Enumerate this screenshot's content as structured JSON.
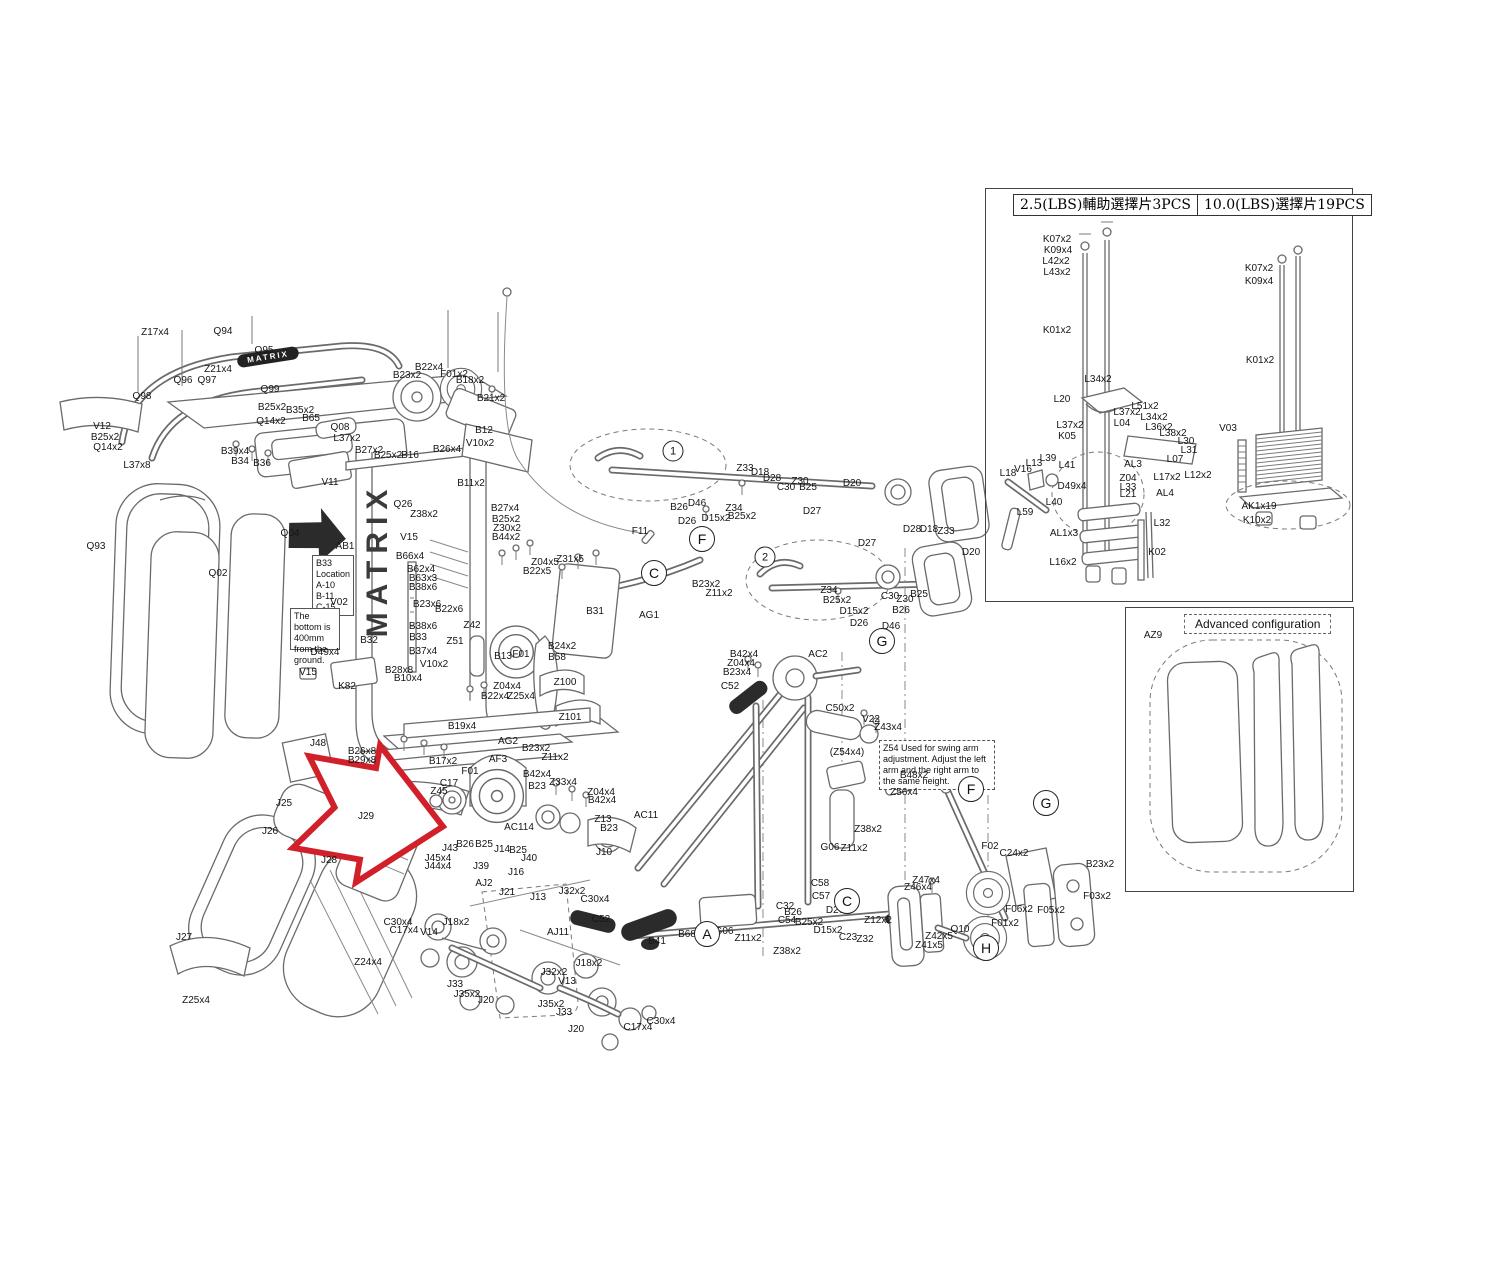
{
  "colors": {
    "background": "#ffffff",
    "line": "#6a6a6a",
    "label": "#151515",
    "arrow_red": "#d1202a",
    "arrow_black": "#111111"
  },
  "brand": "MATRIX",
  "inset_weight_stack": {
    "header_left": "2.5(LBS)輔助選擇片3PCS",
    "header_right": "10.0(LBS)選擇片19PCS"
  },
  "inset_advanced": {
    "title": "Advanced configuration",
    "label": "AZ9"
  },
  "notes": {
    "b33_line1": "B33",
    "b33_line2": "Location",
    "b33_line3": "A-10",
    "b33_line4": "B-11",
    "b33_line5": "C-15",
    "bottom_note": "The bottom is 400mm from the ground.",
    "z54_note": "Z54 Used for swing arm adjustment. Adjust the left arm and the right arm to the same height."
  },
  "callouts": [
    {
      "t": "1",
      "x": 673,
      "y": 451,
      "num": true
    },
    {
      "t": "2",
      "x": 765,
      "y": 557,
      "num": true
    },
    {
      "t": "C",
      "x": 654,
      "y": 573
    },
    {
      "t": "F",
      "x": 702,
      "y": 539
    },
    {
      "t": "G",
      "x": 882,
      "y": 641
    },
    {
      "t": "F",
      "x": 971,
      "y": 789
    },
    {
      "t": "G",
      "x": 1046,
      "y": 803
    },
    {
      "t": "A",
      "x": 707,
      "y": 934
    },
    {
      "t": "C",
      "x": 847,
      "y": 901
    },
    {
      "t": "H",
      "x": 986,
      "y": 948
    }
  ],
  "labels": [
    {
      "t": "Z17x4",
      "x": 155,
      "y": 333
    },
    {
      "t": "Q94",
      "x": 223,
      "y": 332
    },
    {
      "t": "Q95",
      "x": 264,
      "y": 351
    },
    {
      "t": "Z21x4",
      "x": 218,
      "y": 370
    },
    {
      "t": "Q96",
      "x": 183,
      "y": 381
    },
    {
      "t": "Q97",
      "x": 207,
      "y": 381
    },
    {
      "t": "Q98",
      "x": 142,
      "y": 397
    },
    {
      "t": "Q99",
      "x": 270,
      "y": 390
    },
    {
      "t": "B25x2",
      "x": 272,
      "y": 408
    },
    {
      "t": "Q14x2",
      "x": 271,
      "y": 422
    },
    {
      "t": "B35x2",
      "x": 300,
      "y": 411
    },
    {
      "t": "B65",
      "x": 311,
      "y": 419
    },
    {
      "t": "Q08",
      "x": 340,
      "y": 428
    },
    {
      "t": "L37x2",
      "x": 347,
      "y": 439
    },
    {
      "t": "V12",
      "x": 102,
      "y": 427
    },
    {
      "t": "B25x2",
      "x": 105,
      "y": 438
    },
    {
      "t": "Q14x2",
      "x": 108,
      "y": 448
    },
    {
      "t": "L37x8",
      "x": 137,
      "y": 466
    },
    {
      "t": "B39x4",
      "x": 235,
      "y": 452
    },
    {
      "t": "B34",
      "x": 240,
      "y": 462
    },
    {
      "t": "B36",
      "x": 262,
      "y": 464
    },
    {
      "t": "V11",
      "x": 330,
      "y": 483
    },
    {
      "t": "B27x2",
      "x": 369,
      "y": 451
    },
    {
      "t": "B22x4",
      "x": 429,
      "y": 368
    },
    {
      "t": "B23x2",
      "x": 407,
      "y": 376
    },
    {
      "t": "F01x2",
      "x": 454,
      "y": 375
    },
    {
      "t": "B18x2",
      "x": 470,
      "y": 381
    },
    {
      "t": "B21x2",
      "x": 491,
      "y": 399
    },
    {
      "t": "B12",
      "x": 484,
      "y": 431
    },
    {
      "t": "B25x2",
      "x": 388,
      "y": 456
    },
    {
      "t": "B16",
      "x": 410,
      "y": 456
    },
    {
      "t": "B26x4",
      "x": 447,
      "y": 450
    },
    {
      "t": "V10x2",
      "x": 480,
      "y": 444
    },
    {
      "t": "B11x2",
      "x": 471,
      "y": 484
    },
    {
      "t": "Q93",
      "x": 96,
      "y": 547
    },
    {
      "t": "Q02",
      "x": 218,
      "y": 574
    },
    {
      "t": "Q04",
      "x": 290,
      "y": 534
    },
    {
      "t": "AB1",
      "x": 345,
      "y": 547
    },
    {
      "t": "V02",
      "x": 339,
      "y": 603
    },
    {
      "t": "D49x4",
      "x": 325,
      "y": 653
    },
    {
      "t": "V15",
      "x": 308,
      "y": 673
    },
    {
      "t": "K82",
      "x": 347,
      "y": 687
    },
    {
      "t": "J48",
      "x": 318,
      "y": 744
    },
    {
      "t": "Q26",
      "x": 403,
      "y": 505
    },
    {
      "t": "Z38x2",
      "x": 424,
      "y": 515
    },
    {
      "t": "B27x4",
      "x": 505,
      "y": 509
    },
    {
      "t": "B25x2",
      "x": 506,
      "y": 520
    },
    {
      "t": "Z30x2",
      "x": 507,
      "y": 529
    },
    {
      "t": "B44x2",
      "x": 506,
      "y": 538
    },
    {
      "t": "V15",
      "x": 409,
      "y": 538
    },
    {
      "t": "B66x4",
      "x": 410,
      "y": 557
    },
    {
      "t": "B62x4",
      "x": 421,
      "y": 570
    },
    {
      "t": "B63x3",
      "x": 423,
      "y": 579
    },
    {
      "t": "B38x6",
      "x": 423,
      "y": 588
    },
    {
      "t": "B23x6",
      "x": 427,
      "y": 605
    },
    {
      "t": "B22x6",
      "x": 449,
      "y": 610
    },
    {
      "t": "B38x6",
      "x": 423,
      "y": 627
    },
    {
      "t": "B33",
      "x": 418,
      "y": 638
    },
    {
      "t": "Z42",
      "x": 472,
      "y": 626
    },
    {
      "t": "Z51",
      "x": 455,
      "y": 642
    },
    {
      "t": "B32",
      "x": 369,
      "y": 641
    },
    {
      "t": "B37x4",
      "x": 423,
      "y": 652
    },
    {
      "t": "B28x8",
      "x": 399,
      "y": 671
    },
    {
      "t": "B10x4",
      "x": 408,
      "y": 679
    },
    {
      "t": "V10x2",
      "x": 434,
      "y": 665
    },
    {
      "t": "B13",
      "x": 503,
      "y": 657
    },
    {
      "t": "F01",
      "x": 521,
      "y": 655
    },
    {
      "t": "Z04x5",
      "x": 545,
      "y": 563
    },
    {
      "t": "Z31x5",
      "x": 570,
      "y": 560
    },
    {
      "t": "B22x5",
      "x": 537,
      "y": 572
    },
    {
      "t": "B31",
      "x": 595,
      "y": 612
    },
    {
      "t": "AG1",
      "x": 649,
      "y": 616
    },
    {
      "t": "B24x2",
      "x": 562,
      "y": 647
    },
    {
      "t": "B58",
      "x": 557,
      "y": 658
    },
    {
      "t": "Z100",
      "x": 565,
      "y": 683
    },
    {
      "t": "Z04x4",
      "x": 507,
      "y": 687
    },
    {
      "t": "B22x4",
      "x": 495,
      "y": 697
    },
    {
      "t": "Z25x4",
      "x": 521,
      "y": 697
    },
    {
      "t": "Z101",
      "x": 570,
      "y": 718
    },
    {
      "t": "B19x4",
      "x": 462,
      "y": 727
    },
    {
      "t": "AG2",
      "x": 508,
      "y": 742
    },
    {
      "t": "B23x2",
      "x": 536,
      "y": 749
    },
    {
      "t": "Z11x2",
      "x": 555,
      "y": 758
    },
    {
      "t": "B26x8",
      "x": 362,
      "y": 752
    },
    {
      "t": "B29x8",
      "x": 362,
      "y": 761
    },
    {
      "t": "B17x2",
      "x": 443,
      "y": 762
    },
    {
      "t": "B23x2",
      "x": 706,
      "y": 585
    },
    {
      "t": "Z11x2",
      "x": 719,
      "y": 594
    },
    {
      "t": "Z33",
      "x": 745,
      "y": 469
    },
    {
      "t": "D18",
      "x": 760,
      "y": 473
    },
    {
      "t": "D28",
      "x": 772,
      "y": 479
    },
    {
      "t": "C30",
      "x": 786,
      "y": 488
    },
    {
      "t": "Z30",
      "x": 800,
      "y": 482
    },
    {
      "t": "B25",
      "x": 808,
      "y": 488
    },
    {
      "t": "D20",
      "x": 852,
      "y": 484
    },
    {
      "t": "B26",
      "x": 679,
      "y": 508
    },
    {
      "t": "D46",
      "x": 697,
      "y": 504
    },
    {
      "t": "D26",
      "x": 687,
      "y": 522
    },
    {
      "t": "D15x2",
      "x": 716,
      "y": 519
    },
    {
      "t": "Z34",
      "x": 734,
      "y": 509
    },
    {
      "t": "B25x2",
      "x": 742,
      "y": 517
    },
    {
      "t": "F11",
      "x": 640,
      "y": 532
    },
    {
      "t": "D27",
      "x": 812,
      "y": 512
    },
    {
      "t": "D27",
      "x": 867,
      "y": 544
    },
    {
      "t": "D28",
      "x": 912,
      "y": 530
    },
    {
      "t": "D18",
      "x": 929,
      "y": 530
    },
    {
      "t": "Z33",
      "x": 946,
      "y": 532
    },
    {
      "t": "D20",
      "x": 971,
      "y": 553
    },
    {
      "t": "Z34",
      "x": 829,
      "y": 591
    },
    {
      "t": "B25x2",
      "x": 837,
      "y": 601
    },
    {
      "t": "C30",
      "x": 890,
      "y": 597
    },
    {
      "t": "Z30",
      "x": 905,
      "y": 600
    },
    {
      "t": "B25",
      "x": 919,
      "y": 595
    },
    {
      "t": "D15x2",
      "x": 854,
      "y": 612
    },
    {
      "t": "B26",
      "x": 901,
      "y": 611
    },
    {
      "t": "D26",
      "x": 859,
      "y": 624
    },
    {
      "t": "D46",
      "x": 891,
      "y": 627
    },
    {
      "t": "AC2",
      "x": 818,
      "y": 655
    },
    {
      "t": "B42x4",
      "x": 744,
      "y": 655
    },
    {
      "t": "Z04x4",
      "x": 741,
      "y": 664
    },
    {
      "t": "B23x4",
      "x": 737,
      "y": 673
    },
    {
      "t": "C52",
      "x": 730,
      "y": 687
    },
    {
      "t": "C50x2",
      "x": 840,
      "y": 709
    },
    {
      "t": "V22",
      "x": 871,
      "y": 720
    },
    {
      "t": "Z43x4",
      "x": 888,
      "y": 728
    },
    {
      "t": "(Z54x4)",
      "x": 847,
      "y": 753
    },
    {
      "t": "B48x2",
      "x": 914,
      "y": 776
    },
    {
      "t": "Z56x4",
      "x": 904,
      "y": 793
    },
    {
      "t": "Z38x2",
      "x": 868,
      "y": 830
    },
    {
      "t": "Z11x2",
      "x": 854,
      "y": 849
    },
    {
      "t": "G06",
      "x": 830,
      "y": 848
    },
    {
      "t": "AF3",
      "x": 498,
      "y": 760
    },
    {
      "t": "F01",
      "x": 470,
      "y": 772
    },
    {
      "t": "C17",
      "x": 449,
      "y": 784
    },
    {
      "t": "Z45",
      "x": 439,
      "y": 792
    },
    {
      "t": "B42x4",
      "x": 537,
      "y": 775
    },
    {
      "t": "B23",
      "x": 537,
      "y": 787
    },
    {
      "t": "Z33x4",
      "x": 563,
      "y": 783
    },
    {
      "t": "Z04x4",
      "x": 601,
      "y": 793
    },
    {
      "t": "B42x4",
      "x": 602,
      "y": 801
    },
    {
      "t": "Z13",
      "x": 603,
      "y": 820
    },
    {
      "t": "B23",
      "x": 609,
      "y": 829
    },
    {
      "t": "AC114",
      "x": 519,
      "y": 828
    },
    {
      "t": "AC11",
      "x": 646,
      "y": 816
    },
    {
      "t": "J10",
      "x": 604,
      "y": 853
    },
    {
      "t": "J43",
      "x": 450,
      "y": 849
    },
    {
      "t": "B26",
      "x": 465,
      "y": 845
    },
    {
      "t": "B25",
      "x": 484,
      "y": 845
    },
    {
      "t": "J14",
      "x": 502,
      "y": 850
    },
    {
      "t": "B25",
      "x": 518,
      "y": 851
    },
    {
      "t": "J40",
      "x": 529,
      "y": 859
    },
    {
      "t": "J45x4",
      "x": 438,
      "y": 859
    },
    {
      "t": "J44x4",
      "x": 438,
      "y": 867
    },
    {
      "t": "J39",
      "x": 481,
      "y": 867
    },
    {
      "t": "J16",
      "x": 516,
      "y": 873
    },
    {
      "t": "AJ2",
      "x": 484,
      "y": 884
    },
    {
      "t": "J21",
      "x": 507,
      "y": 893
    },
    {
      "t": "J13",
      "x": 538,
      "y": 898
    },
    {
      "t": "J32x2",
      "x": 572,
      "y": 892
    },
    {
      "t": "C30x4",
      "x": 595,
      "y": 900
    },
    {
      "t": "C52",
      "x": 601,
      "y": 920
    },
    {
      "t": "B41",
      "x": 657,
      "y": 942
    },
    {
      "t": "V14",
      "x": 429,
      "y": 933
    },
    {
      "t": "J18x2",
      "x": 456,
      "y": 923
    },
    {
      "t": "C30x4",
      "x": 398,
      "y": 923
    },
    {
      "t": "C17x4",
      "x": 404,
      "y": 931
    },
    {
      "t": "AJ11",
      "x": 558,
      "y": 933
    },
    {
      "t": "J32x2",
      "x": 554,
      "y": 973
    },
    {
      "t": "V13",
      "x": 567,
      "y": 982
    },
    {
      "t": "J33",
      "x": 455,
      "y": 985
    },
    {
      "t": "J35x2",
      "x": 467,
      "y": 995
    },
    {
      "t": "J20",
      "x": 486,
      "y": 1001
    },
    {
      "t": "J35x2",
      "x": 551,
      "y": 1005
    },
    {
      "t": "J33",
      "x": 564,
      "y": 1013
    },
    {
      "t": "J20",
      "x": 576,
      "y": 1030
    },
    {
      "t": "J18x2",
      "x": 589,
      "y": 964
    },
    {
      "t": "C30x4",
      "x": 661,
      "y": 1022
    },
    {
      "t": "C17x4",
      "x": 638,
      "y": 1028
    },
    {
      "t": "J25",
      "x": 284,
      "y": 804
    },
    {
      "t": "J26",
      "x": 270,
      "y": 832
    },
    {
      "t": "J29",
      "x": 366,
      "y": 817
    },
    {
      "t": "J28",
      "x": 329,
      "y": 861
    },
    {
      "t": "J27",
      "x": 184,
      "y": 938
    },
    {
      "t": "Z25x4",
      "x": 196,
      "y": 1001
    },
    {
      "t": "Z24x4",
      "x": 368,
      "y": 963
    },
    {
      "t": "B68",
      "x": 687,
      "y": 935
    },
    {
      "t": "G06",
      "x": 724,
      "y": 932
    },
    {
      "t": "Z11x2",
      "x": 748,
      "y": 939
    },
    {
      "t": "Z38x2",
      "x": 787,
      "y": 952
    },
    {
      "t": "C58",
      "x": 820,
      "y": 884
    },
    {
      "t": "C57",
      "x": 821,
      "y": 897
    },
    {
      "t": "C32",
      "x": 785,
      "y": 907
    },
    {
      "t": "B26",
      "x": 793,
      "y": 913
    },
    {
      "t": "C54",
      "x": 787,
      "y": 921
    },
    {
      "t": "B25x2",
      "x": 809,
      "y": 923
    },
    {
      "t": "D26",
      "x": 835,
      "y": 911
    },
    {
      "t": "D15x2",
      "x": 828,
      "y": 931
    },
    {
      "t": "C23",
      "x": 848,
      "y": 938
    },
    {
      "t": "Z32",
      "x": 865,
      "y": 940
    },
    {
      "t": "Z12x2",
      "x": 878,
      "y": 921
    },
    {
      "t": "F02",
      "x": 990,
      "y": 847
    },
    {
      "t": "C24x2",
      "x": 1014,
      "y": 854
    },
    {
      "t": "B23x2",
      "x": 1100,
      "y": 865
    },
    {
      "t": "F03x2",
      "x": 1097,
      "y": 897
    },
    {
      "t": "F06x2",
      "x": 1019,
      "y": 910
    },
    {
      "t": "F05x2",
      "x": 1051,
      "y": 911
    },
    {
      "t": "F01x2",
      "x": 1005,
      "y": 924
    },
    {
      "t": "Z47x4",
      "x": 926,
      "y": 881
    },
    {
      "t": "Z46x4",
      "x": 918,
      "y": 888
    },
    {
      "t": "Q10",
      "x": 960,
      "y": 930
    },
    {
      "t": "Z42x5",
      "x": 939,
      "y": 937
    },
    {
      "t": "Z41x5",
      "x": 929,
      "y": 946
    },
    {
      "t": "K07x2",
      "x": 1057,
      "y": 240
    },
    {
      "t": "K09x4",
      "x": 1058,
      "y": 251
    },
    {
      "t": "L42x2",
      "x": 1056,
      "y": 262
    },
    {
      "t": "L43x2",
      "x": 1057,
      "y": 273
    },
    {
      "t": "K01x2",
      "x": 1057,
      "y": 331
    },
    {
      "t": "L34x2",
      "x": 1098,
      "y": 380
    },
    {
      "t": "L20",
      "x": 1062,
      "y": 400
    },
    {
      "t": "L51x2",
      "x": 1145,
      "y": 407
    },
    {
      "t": "L37x2",
      "x": 1127,
      "y": 413
    },
    {
      "t": "L34x2",
      "x": 1154,
      "y": 418
    },
    {
      "t": "L37x2",
      "x": 1070,
      "y": 426
    },
    {
      "t": "L04",
      "x": 1122,
      "y": 424
    },
    {
      "t": "L36x2",
      "x": 1159,
      "y": 428
    },
    {
      "t": "K05",
      "x": 1067,
      "y": 437
    },
    {
      "t": "L38x2",
      "x": 1173,
      "y": 434
    },
    {
      "t": "L30",
      "x": 1186,
      "y": 442
    },
    {
      "t": "L31",
      "x": 1189,
      "y": 451
    },
    {
      "t": "L07",
      "x": 1175,
      "y": 460
    },
    {
      "t": "L39",
      "x": 1048,
      "y": 459
    },
    {
      "t": "L13",
      "x": 1034,
      "y": 464
    },
    {
      "t": "L41",
      "x": 1067,
      "y": 466
    },
    {
      "t": "V16",
      "x": 1023,
      "y": 470
    },
    {
      "t": "L18",
      "x": 1008,
      "y": 474
    },
    {
      "t": "AL3",
      "x": 1133,
      "y": 465
    },
    {
      "t": "L17x2",
      "x": 1167,
      "y": 478
    },
    {
      "t": "L12x2",
      "x": 1198,
      "y": 476
    },
    {
      "t": "Z04",
      "x": 1128,
      "y": 479
    },
    {
      "t": "D49x4",
      "x": 1072,
      "y": 487
    },
    {
      "t": "L33",
      "x": 1128,
      "y": 488
    },
    {
      "t": "L21",
      "x": 1128,
      "y": 495
    },
    {
      "t": "AL4",
      "x": 1165,
      "y": 494
    },
    {
      "t": "L40",
      "x": 1054,
      "y": 503
    },
    {
      "t": "L59",
      "x": 1025,
      "y": 513
    },
    {
      "t": "AL1x3",
      "x": 1064,
      "y": 534
    },
    {
      "t": "L32",
      "x": 1162,
      "y": 524
    },
    {
      "t": "K02",
      "x": 1157,
      "y": 553
    },
    {
      "t": "L16x2",
      "x": 1063,
      "y": 563
    },
    {
      "t": "K07x2",
      "x": 1259,
      "y": 269
    },
    {
      "t": "K09x4",
      "x": 1259,
      "y": 282
    },
    {
      "t": "K01x2",
      "x": 1260,
      "y": 361
    },
    {
      "t": "V03",
      "x": 1228,
      "y": 429
    },
    {
      "t": "AK1x19",
      "x": 1259,
      "y": 507
    },
    {
      "t": "K10x2",
      "x": 1257,
      "y": 521
    },
    {
      "t": "AZ9",
      "x": 1153,
      "y": 636
    }
  ]
}
